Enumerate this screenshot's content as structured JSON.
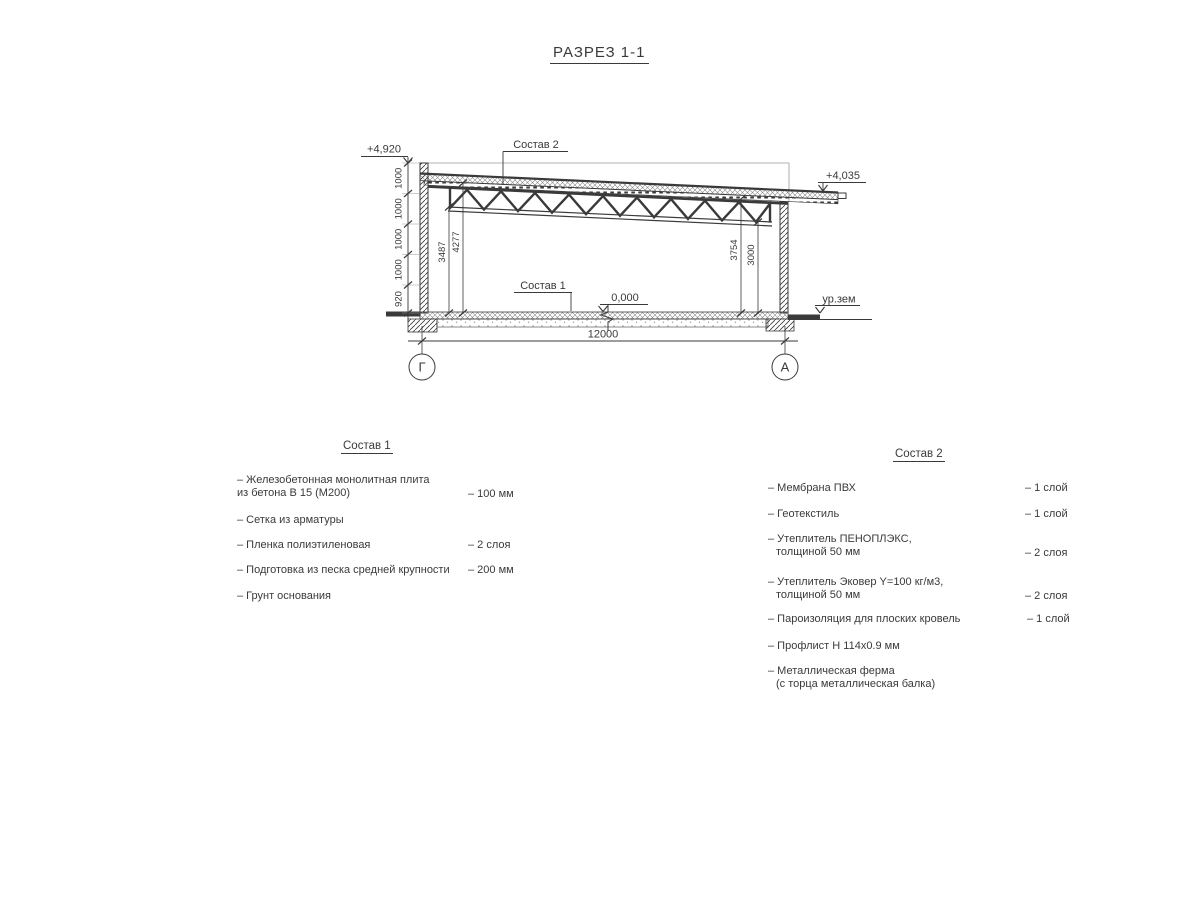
{
  "title": "РАЗРЕЗ 1-1",
  "drawing": {
    "elevations": {
      "top_left": "+4,920",
      "top_right": "+4,035",
      "floor": "0,000",
      "ground": "ур.зем"
    },
    "leaders": {
      "sostav1": "Состав 1",
      "sostav2": "Состав 2"
    },
    "dims": {
      "left_chain": [
        "1000",
        "1000",
        "1000",
        "1000",
        "920"
      ],
      "interior_left_outer": "3487",
      "interior_left_inner": "4277",
      "interior_right_outer": "3754",
      "interior_right_inner": "3000",
      "span": "12000"
    },
    "axes": {
      "left": "Г",
      "right": "А"
    }
  },
  "sostav1": {
    "title": "Состав 1",
    "items": [
      {
        "name": "– Железобетонная  монолитная плита",
        "name2": "из бетона В 15 (М200)",
        "value": "– 100 мм"
      },
      {
        "name": "– Сетка из арматуры",
        "name2": "",
        "value": ""
      },
      {
        "name": "– Пленка полиэтиленовая",
        "name2": "",
        "value": "– 2 слоя"
      },
      {
        "name": "– Подготовка из песка средней крупности",
        "name2": "",
        "value": "– 200 мм"
      },
      {
        "name": "– Грунт основания",
        "name2": "",
        "value": ""
      }
    ]
  },
  "sostav2": {
    "title": "Состав 2",
    "items": [
      {
        "name": "– Мембрана ПВХ",
        "name2": "",
        "value": "– 1 слой"
      },
      {
        "name": "– Геотекстиль",
        "name2": "",
        "value": "– 1 слой"
      },
      {
        "name": "– Утеплитель ПЕНОПЛЭКС,",
        "name2": "толщиной 50 мм",
        "value": "– 2 слоя"
      },
      {
        "name": "– Утеплитель Эковер Y=100 кг/м3,",
        "name2": "толщиной 50 мм",
        "value": "– 2 слоя"
      },
      {
        "name": "– Пароизоляция для плоских кровель",
        "name2": "",
        "value": "– 1 слой"
      },
      {
        "name": "– Профлист Н 114х0.9 мм",
        "name2": "",
        "value": ""
      },
      {
        "name": "– Металлическая ферма",
        "name2": "(с торца металлическая балка)",
        "value": ""
      }
    ]
  }
}
